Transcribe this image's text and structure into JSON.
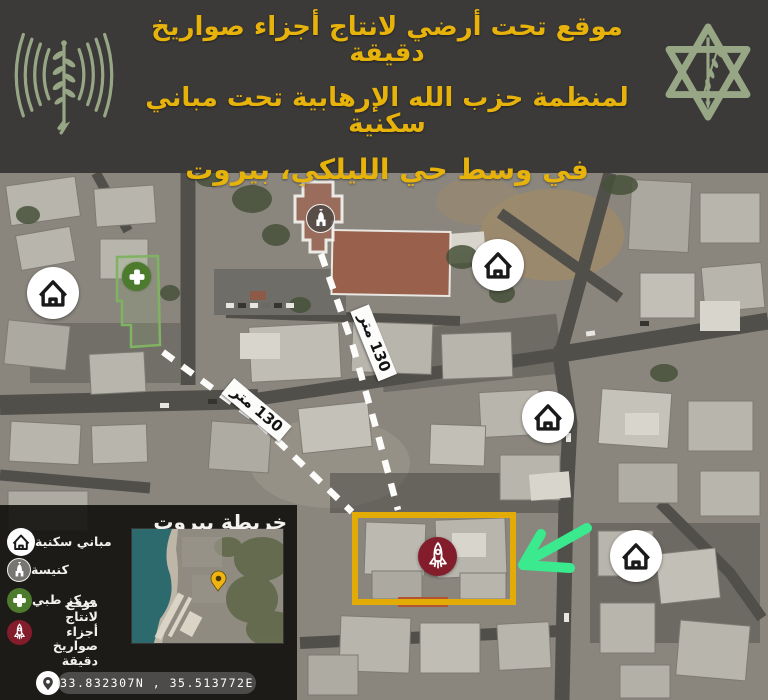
{
  "header": {
    "line1": "موقع تحت أرضي لانتاج أجزاء صواريخ دقيقة",
    "line2": "لمنظمة حزب الله الإرهابية تحت مباني سكنية",
    "line3": "في وسط حي الليلكي، بيروت"
  },
  "map": {
    "distance_label_a": "130 متر",
    "distance_label_b": "130 متر"
  },
  "legend": {
    "title": "خريطة بيروت",
    "items": [
      {
        "label": "مباني سكنية",
        "icon": "house-icon"
      },
      {
        "label": "كنيسة",
        "icon": "church-icon"
      },
      {
        "label": "مركز طبي",
        "icon": "medical-cross-icon"
      },
      {
        "label": "موقع لانتاج أجزاء صواريخ دقيقة",
        "icon": "rocket-icon"
      }
    ],
    "coordinates": "33.832307N , 35.513772E"
  },
  "colors": {
    "header_background": "#3b3a39",
    "header_text": "#e7b30b",
    "emblem_green": "#97a685",
    "highlight_yellow": "#e2ab05",
    "arrow_green": "#3be98e",
    "rocket_red": "#831c2b",
    "medical_green": "#4c7b2e"
  }
}
